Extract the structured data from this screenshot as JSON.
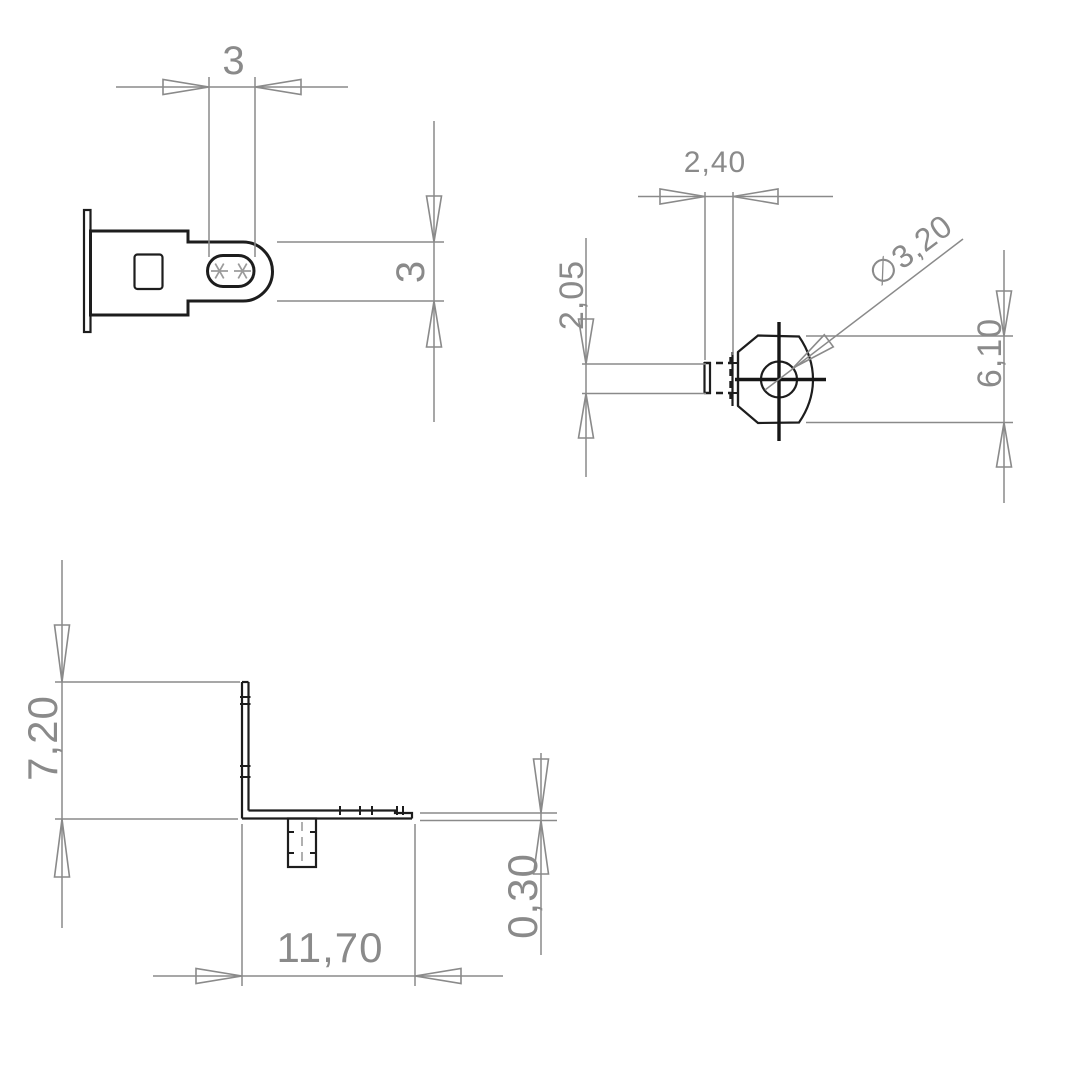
{
  "colors": {
    "outline": "#1d1d1d",
    "dimension": "#8a8a8a",
    "centerline": "#161616",
    "background": "#ffffff"
  },
  "views": {
    "tab_top": {
      "slot_width": "3",
      "tab_width": "3"
    },
    "lug_front": {
      "stub_length": "2,40",
      "stub_thickness": "2,05",
      "hole_diameter": "∅3,20",
      "lug_width": "6,10"
    },
    "bracket_side": {
      "leg_height": "7,20",
      "base_length": "11,70",
      "material_thickness": "0,30"
    }
  }
}
